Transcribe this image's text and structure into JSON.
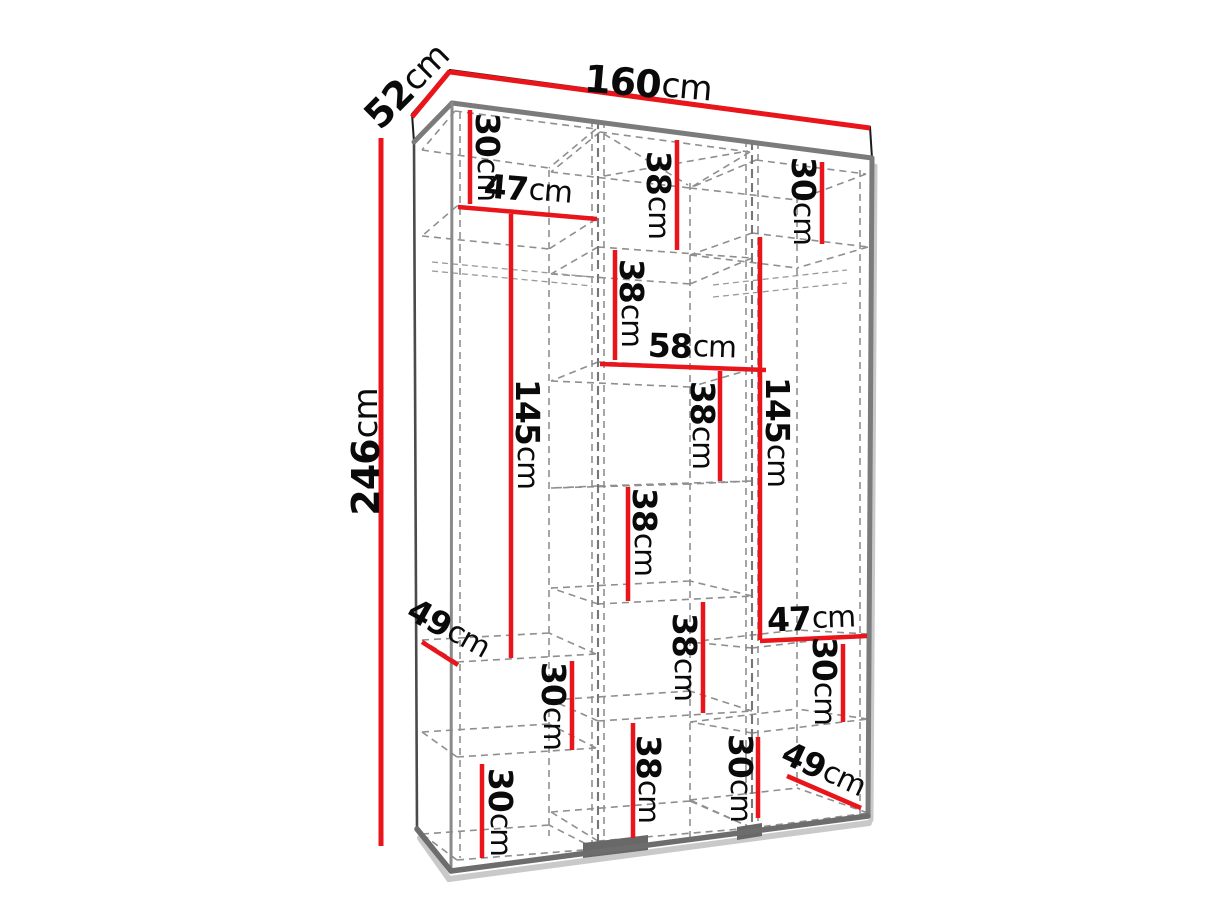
{
  "diagram": {
    "kind": "wardrobe-dimension-diagram",
    "unit": "cm",
    "accent_color": "#e9151b",
    "overall": {
      "width_label": "160cm",
      "depth_label": "52cm",
      "height_label": "246cm"
    },
    "dimensions": [
      {
        "label": "160cm",
        "value": "160",
        "unit": "cm",
        "x1": 450,
        "y1": 72,
        "x2": 870,
        "y2": 128,
        "tx": 648,
        "ty": 84,
        "rot": 5,
        "size": 38,
        "w": 5
      },
      {
        "label": "52cm",
        "value": "52",
        "unit": "cm",
        "x1": 412,
        "y1": 117,
        "x2": 450,
        "y2": 71,
        "tx": 407,
        "ty": 86,
        "rot": -45,
        "size": 38,
        "w": 5
      },
      {
        "label": "246cm",
        "value": "246",
        "unit": "cm",
        "x1": 381,
        "y1": 138,
        "x2": 381,
        "y2": 846,
        "tx": 366,
        "ty": 452,
        "rot": -90,
        "size": 38,
        "w": 5
      },
      {
        "label": "30cm",
        "value": "30",
        "unit": "cm",
        "x1": 470,
        "y1": 110,
        "x2": 470,
        "y2": 204,
        "tx": 488,
        "ty": 157,
        "rot": 90,
        "size": 33,
        "w": 4.5
      },
      {
        "label": "47cm",
        "value": "47",
        "unit": "cm",
        "x1": 458,
        "y1": 207,
        "x2": 597,
        "y2": 219,
        "tx": 528,
        "ty": 189,
        "rot": 5,
        "size": 33,
        "w": 4.5
      },
      {
        "label": "38cm",
        "value": "38",
        "unit": "cm",
        "x1": 677,
        "y1": 140,
        "x2": 677,
        "y2": 250,
        "tx": 659,
        "ty": 195,
        "rot": 90,
        "size": 33,
        "w": 4.5
      },
      {
        "label": "30cm",
        "value": "30",
        "unit": "cm",
        "x1": 822,
        "y1": 162,
        "x2": 822,
        "y2": 244,
        "tx": 804,
        "ty": 201,
        "rot": 90,
        "size": 33,
        "w": 4.5
      },
      {
        "label": "38cm",
        "value": "38",
        "unit": "cm",
        "x1": 615,
        "y1": 250,
        "x2": 615,
        "y2": 360,
        "tx": 632,
        "ty": 303,
        "rot": 90,
        "size": 33,
        "w": 4.5
      },
      {
        "label": "58cm",
        "value": "58",
        "unit": "cm",
        "x1": 600,
        "y1": 364,
        "x2": 766,
        "y2": 370,
        "tx": 692,
        "ty": 346,
        "rot": 2,
        "size": 33,
        "w": 4.5
      },
      {
        "label": "145cm",
        "value": "145",
        "unit": "cm",
        "x1": 511,
        "y1": 214,
        "x2": 511,
        "y2": 658,
        "tx": 528,
        "ty": 434,
        "rot": 90,
        "size": 33,
        "w": 4.5
      },
      {
        "label": "145cm",
        "value": "145",
        "unit": "cm",
        "x1": 760,
        "y1": 237,
        "x2": 760,
        "y2": 640,
        "tx": 778,
        "ty": 432,
        "rot": 90,
        "size": 33,
        "w": 4.5
      },
      {
        "label": "38cm",
        "value": "38",
        "unit": "cm",
        "x1": 720,
        "y1": 371,
        "x2": 720,
        "y2": 481,
        "tx": 703,
        "ty": 425,
        "rot": 90,
        "size": 33,
        "w": 4.5
      },
      {
        "label": "38cm",
        "value": "38",
        "unit": "cm",
        "x1": 628,
        "y1": 487,
        "x2": 628,
        "y2": 601,
        "tx": 645,
        "ty": 532,
        "rot": 90,
        "size": 33,
        "w": 4.5
      },
      {
        "label": "47cm",
        "value": "47",
        "unit": "cm",
        "x1": 760,
        "y1": 641,
        "x2": 867,
        "y2": 636,
        "tx": 811,
        "ty": 618,
        "rot": -2,
        "size": 33,
        "w": 4.5
      },
      {
        "label": "30cm",
        "value": "30",
        "unit": "cm",
        "x1": 843,
        "y1": 644,
        "x2": 843,
        "y2": 722,
        "tx": 825,
        "ty": 681,
        "rot": 90,
        "size": 33,
        "w": 4.5
      },
      {
        "label": "49cm",
        "value": "49",
        "unit": "cm",
        "x1": 422,
        "y1": 642,
        "x2": 458,
        "y2": 665,
        "tx": 449,
        "ty": 628,
        "rot": 29,
        "size": 33,
        "w": 4.5
      },
      {
        "label": "30cm",
        "value": "30",
        "unit": "cm",
        "x1": 572,
        "y1": 661,
        "x2": 572,
        "y2": 750,
        "tx": 554,
        "ty": 706,
        "rot": 90,
        "size": 33,
        "w": 4.5
      },
      {
        "label": "38cm",
        "value": "38",
        "unit": "cm",
        "x1": 703,
        "y1": 602,
        "x2": 703,
        "y2": 713,
        "tx": 685,
        "ty": 657,
        "rot": 90,
        "size": 33,
        "w": 4.5
      },
      {
        "label": "38cm",
        "value": "38",
        "unit": "cm",
        "x1": 633,
        "y1": 723,
        "x2": 633,
        "y2": 838,
        "tx": 649,
        "ty": 779,
        "rot": 90,
        "size": 33,
        "w": 4.5
      },
      {
        "label": "30cm",
        "value": "30",
        "unit": "cm",
        "x1": 482,
        "y1": 764,
        "x2": 482,
        "y2": 858,
        "tx": 501,
        "ty": 812,
        "rot": 90,
        "size": 33,
        "w": 4.5
      },
      {
        "label": "30cm",
        "value": "30",
        "unit": "cm",
        "x1": 758,
        "y1": 737,
        "x2": 758,
        "y2": 818,
        "tx": 741,
        "ty": 778,
        "rot": 90,
        "size": 33,
        "w": 4.5
      },
      {
        "label": "49cm",
        "value": "49",
        "unit": "cm",
        "x1": 787,
        "y1": 776,
        "x2": 861,
        "y2": 808,
        "tx": 824,
        "ty": 769,
        "rot": 25,
        "size": 33,
        "w": 4.5
      }
    ]
  }
}
